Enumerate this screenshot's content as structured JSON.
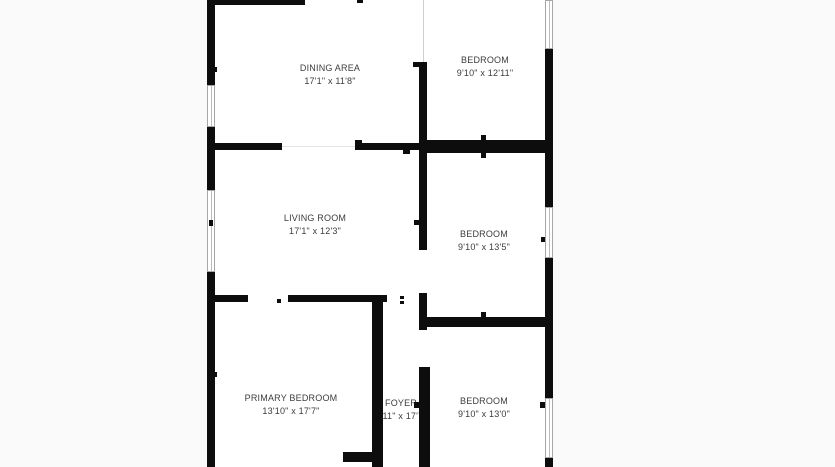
{
  "floorplan": {
    "rooms": [
      {
        "id": "dining-area",
        "name": "DINING AREA",
        "dimensions": "17'1\" x 11'8\""
      },
      {
        "id": "bedroom-top",
        "name": "BEDROOM",
        "dimensions": "9'10\" x 12'11\""
      },
      {
        "id": "living-room",
        "name": "LIVING ROOM",
        "dimensions": "17'1\" x 12'3\""
      },
      {
        "id": "bedroom-middle",
        "name": "BEDROOM",
        "dimensions": "9'10\" x 13'5\""
      },
      {
        "id": "primary-bedroom",
        "name": "PRIMARY BEDROOM",
        "dimensions": "13'10\" x 17'7\""
      },
      {
        "id": "foyer",
        "name": "FOYER",
        "dimensions": "2'11\" x 17'7\""
      },
      {
        "id": "bedroom-bottom",
        "name": "BEDROOM",
        "dimensions": "9'10\" x 13'0\""
      }
    ],
    "colors": {
      "wall": "#0d0d0d",
      "background": "#fafafa",
      "room_fill": "#ffffff",
      "label_text": "#3c3c3c",
      "window_frame": "#a6a6a6"
    }
  }
}
